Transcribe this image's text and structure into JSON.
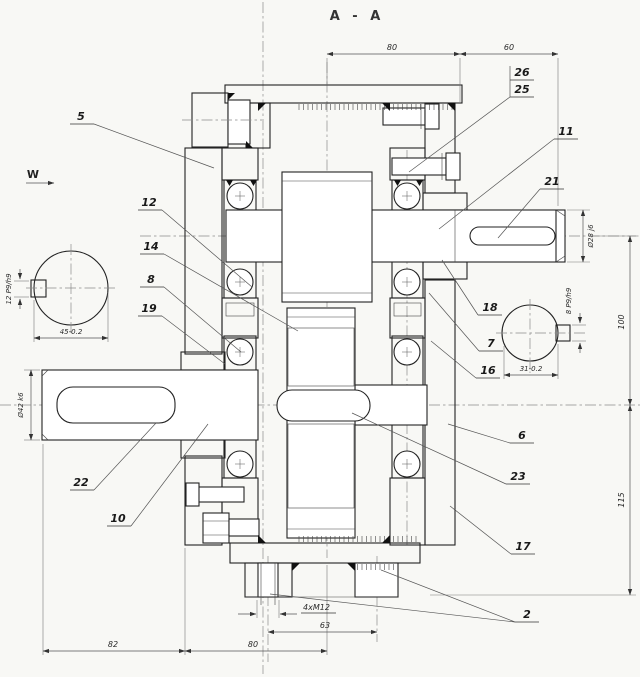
{
  "drawing": {
    "title": "A - A",
    "view_arrow": "W",
    "labels": {
      "n2": "2",
      "n5": "5",
      "n6": "6",
      "n7": "7",
      "n8": "8",
      "n10": "10",
      "n11": "11",
      "n12": "12",
      "n14": "14",
      "n16": "16",
      "n17": "17",
      "n18": "18",
      "n19": "19",
      "n21": "21",
      "n22": "22",
      "n23": "23",
      "n25": "25",
      "n26": "26"
    },
    "dims": {
      "top80": "80",
      "top60": "60",
      "dia28": "Ø28 j6",
      "v100": "100",
      "v115": "115",
      "dia42": "Ø42 k6",
      "key12": "12 P9/h9",
      "w45": "45-0.2",
      "key8": "8 P9/h9",
      "w31": "31-0.2",
      "b82": "82",
      "b80": "80",
      "b63": "63",
      "bolts": "4xM12"
    },
    "colors": {
      "line": "#222222",
      "paper": "#f8f8f5"
    }
  }
}
